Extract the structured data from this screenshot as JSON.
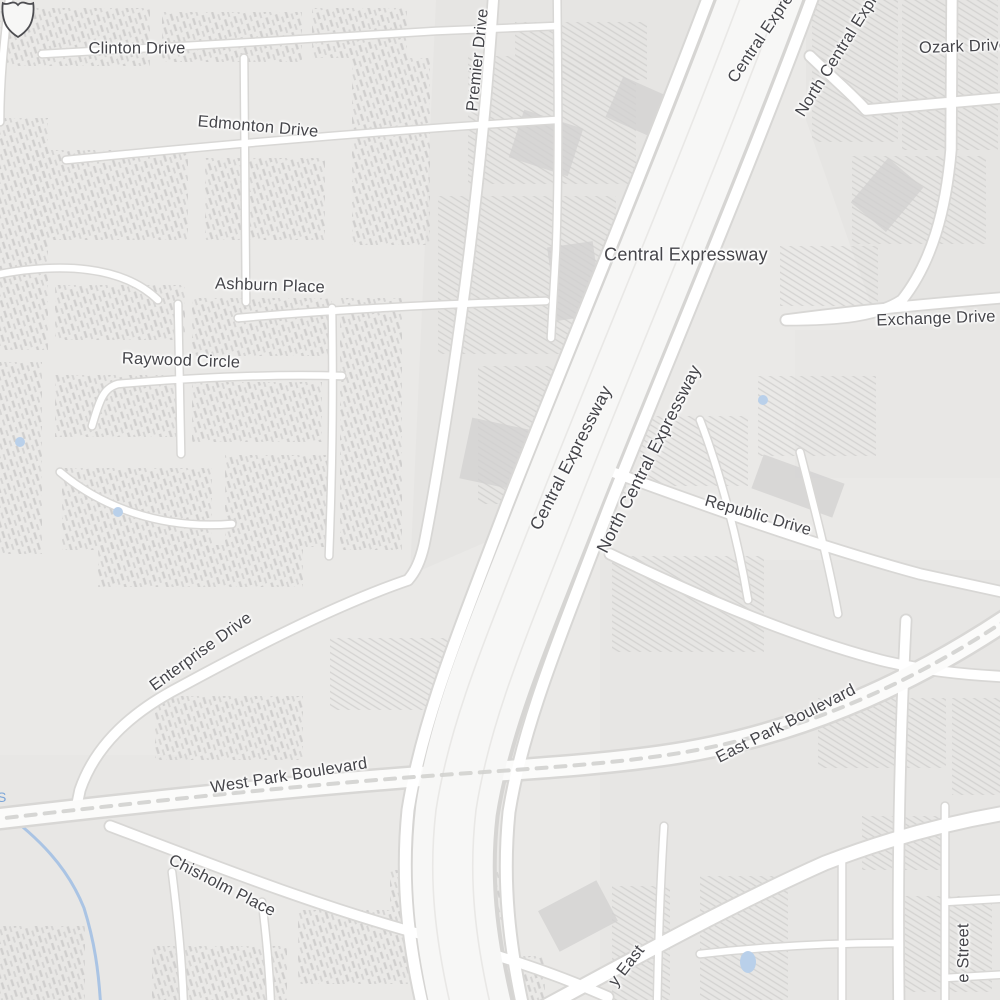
{
  "map": {
    "labels": {
      "clinton": "Clinton Drive",
      "edmonton": "Edmonton Drive",
      "ashburn": "Ashburn Place",
      "raywood": "Raywood Circle",
      "premier": "Premier Drive",
      "central_expressway_top": "Central Expressway",
      "north_central_top": "North Central Expressway",
      "ozark": "Ozark Drive",
      "central_expressway_shielded": "Central Expressway",
      "exchange": "Exchange Drive",
      "central_expressway_freeway": "Central Expressway",
      "north_central_frontage": "North Central Expressway",
      "republic": "Republic Drive",
      "enterprise": "Enterprise Drive",
      "west_park": "West Park Boulevard",
      "east_park": "East Park Boulevard",
      "chisholm": "Chisholm Place",
      "parkway_east_fragment": "y East",
      "street_fragment": "e Street",
      "water_label_fragment": "S"
    },
    "icons": {
      "us_route_shield": "blank US highway route shield outline"
    },
    "colors": {
      "background": "#eae9e7",
      "block_tint": "#e6e5e3",
      "road_fill": "#ffffff",
      "road_casing": "#d8d7d5",
      "freeway_fill": "#f7f7f6",
      "railway": "#d2d1cf",
      "water": "#a6c2e4",
      "label_text": "#45454a",
      "building_hatch": "#c9c8c7"
    }
  }
}
